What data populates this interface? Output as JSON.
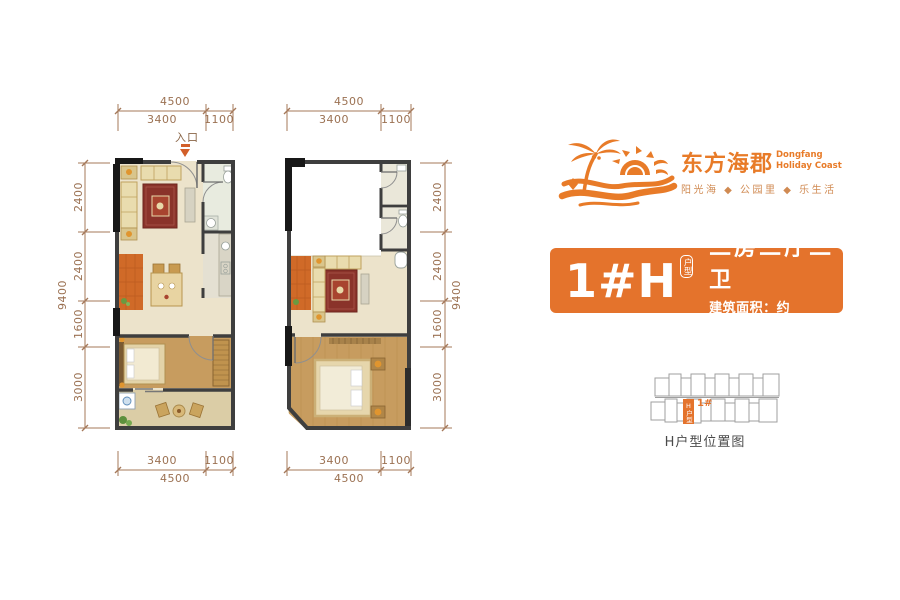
{
  "brand": {
    "name_cn": "东方海郡",
    "name_en_1": "Dongfang",
    "name_en_2": "Holiday Coast",
    "tagline": "阳光海 ◆ 公园里 ◆ 乐生活",
    "accent_color": "#e87b28"
  },
  "unit_card": {
    "code": "1#H",
    "code_tag": "户型",
    "rooms": "二房二厅二卫",
    "area": "建筑面积：约47.73m²",
    "bg_color": "#e4732c"
  },
  "fp": {
    "entrance_label": "入口",
    "left": {
      "top": {
        "total": "4500",
        "seg1": "3400",
        "seg2": "1100"
      },
      "bottom": {
        "total": "4500",
        "seg1": "3400",
        "seg2": "1100"
      },
      "side": {
        "total": "9400",
        "seg1": "2400",
        "seg2": "2400",
        "seg3": "1600",
        "seg4": "3000"
      }
    },
    "right": {
      "top": {
        "total": "4500",
        "seg1": "3400",
        "seg2": "1100"
      },
      "bottom": {
        "total": "4500",
        "seg1": "3400",
        "seg2": "1100"
      },
      "side": {
        "total": "9400",
        "seg1": "2400",
        "seg2": "2400",
        "seg3": "1600",
        "seg4": "3000"
      }
    }
  },
  "locator": {
    "unit_label": "1#",
    "block_label": "H户型",
    "caption": "H户型位置图"
  },
  "colors": {
    "dimension_text": "#9b7152",
    "wall": "#3e3e3e",
    "wood_floor": "#c79c5f",
    "orange_tile": "#d06a28",
    "rug_red": "#8a332a"
  }
}
